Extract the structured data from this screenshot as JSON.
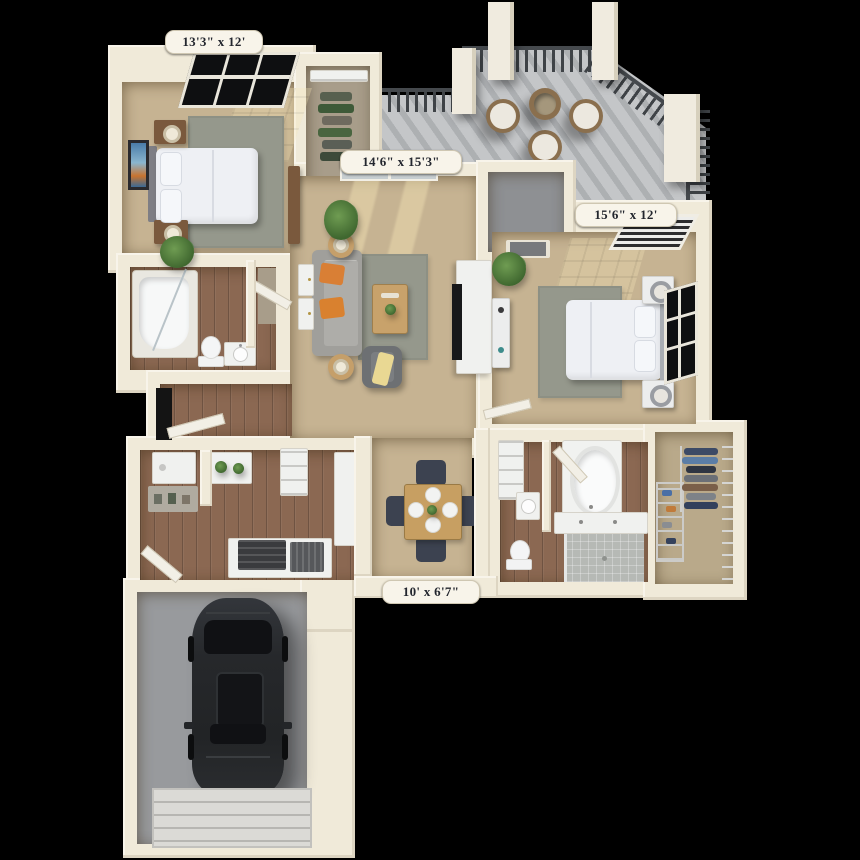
{
  "floorplan": {
    "title": "2 Bed 2 Bath Apartment 3D Floor Plan",
    "rooms": [
      {
        "id": "bedroom-1",
        "dimensions": "13'3\" x 12'"
      },
      {
        "id": "living-room",
        "dimensions": "14'6\" x 15'3\""
      },
      {
        "id": "bedroom-2",
        "dimensions": "15'6\" x 12'"
      },
      {
        "id": "patio",
        "dimensions": "10' x 6'7\""
      }
    ],
    "colors": {
      "background": "#000000",
      "wall": "#f0ead9",
      "carpet": "#c6b392",
      "rug": "#95988c",
      "wood_floor": "#8b6852",
      "balcony_concrete": "#c4c6c8",
      "railing": "#3f4346",
      "garage_floor": "#989a9d",
      "car_body": "#26282b",
      "accent_pillow": "#d97f35",
      "dining_chair": "#3c4250",
      "label_background": "#f8f4ea",
      "label_text": "#23262e"
    }
  }
}
